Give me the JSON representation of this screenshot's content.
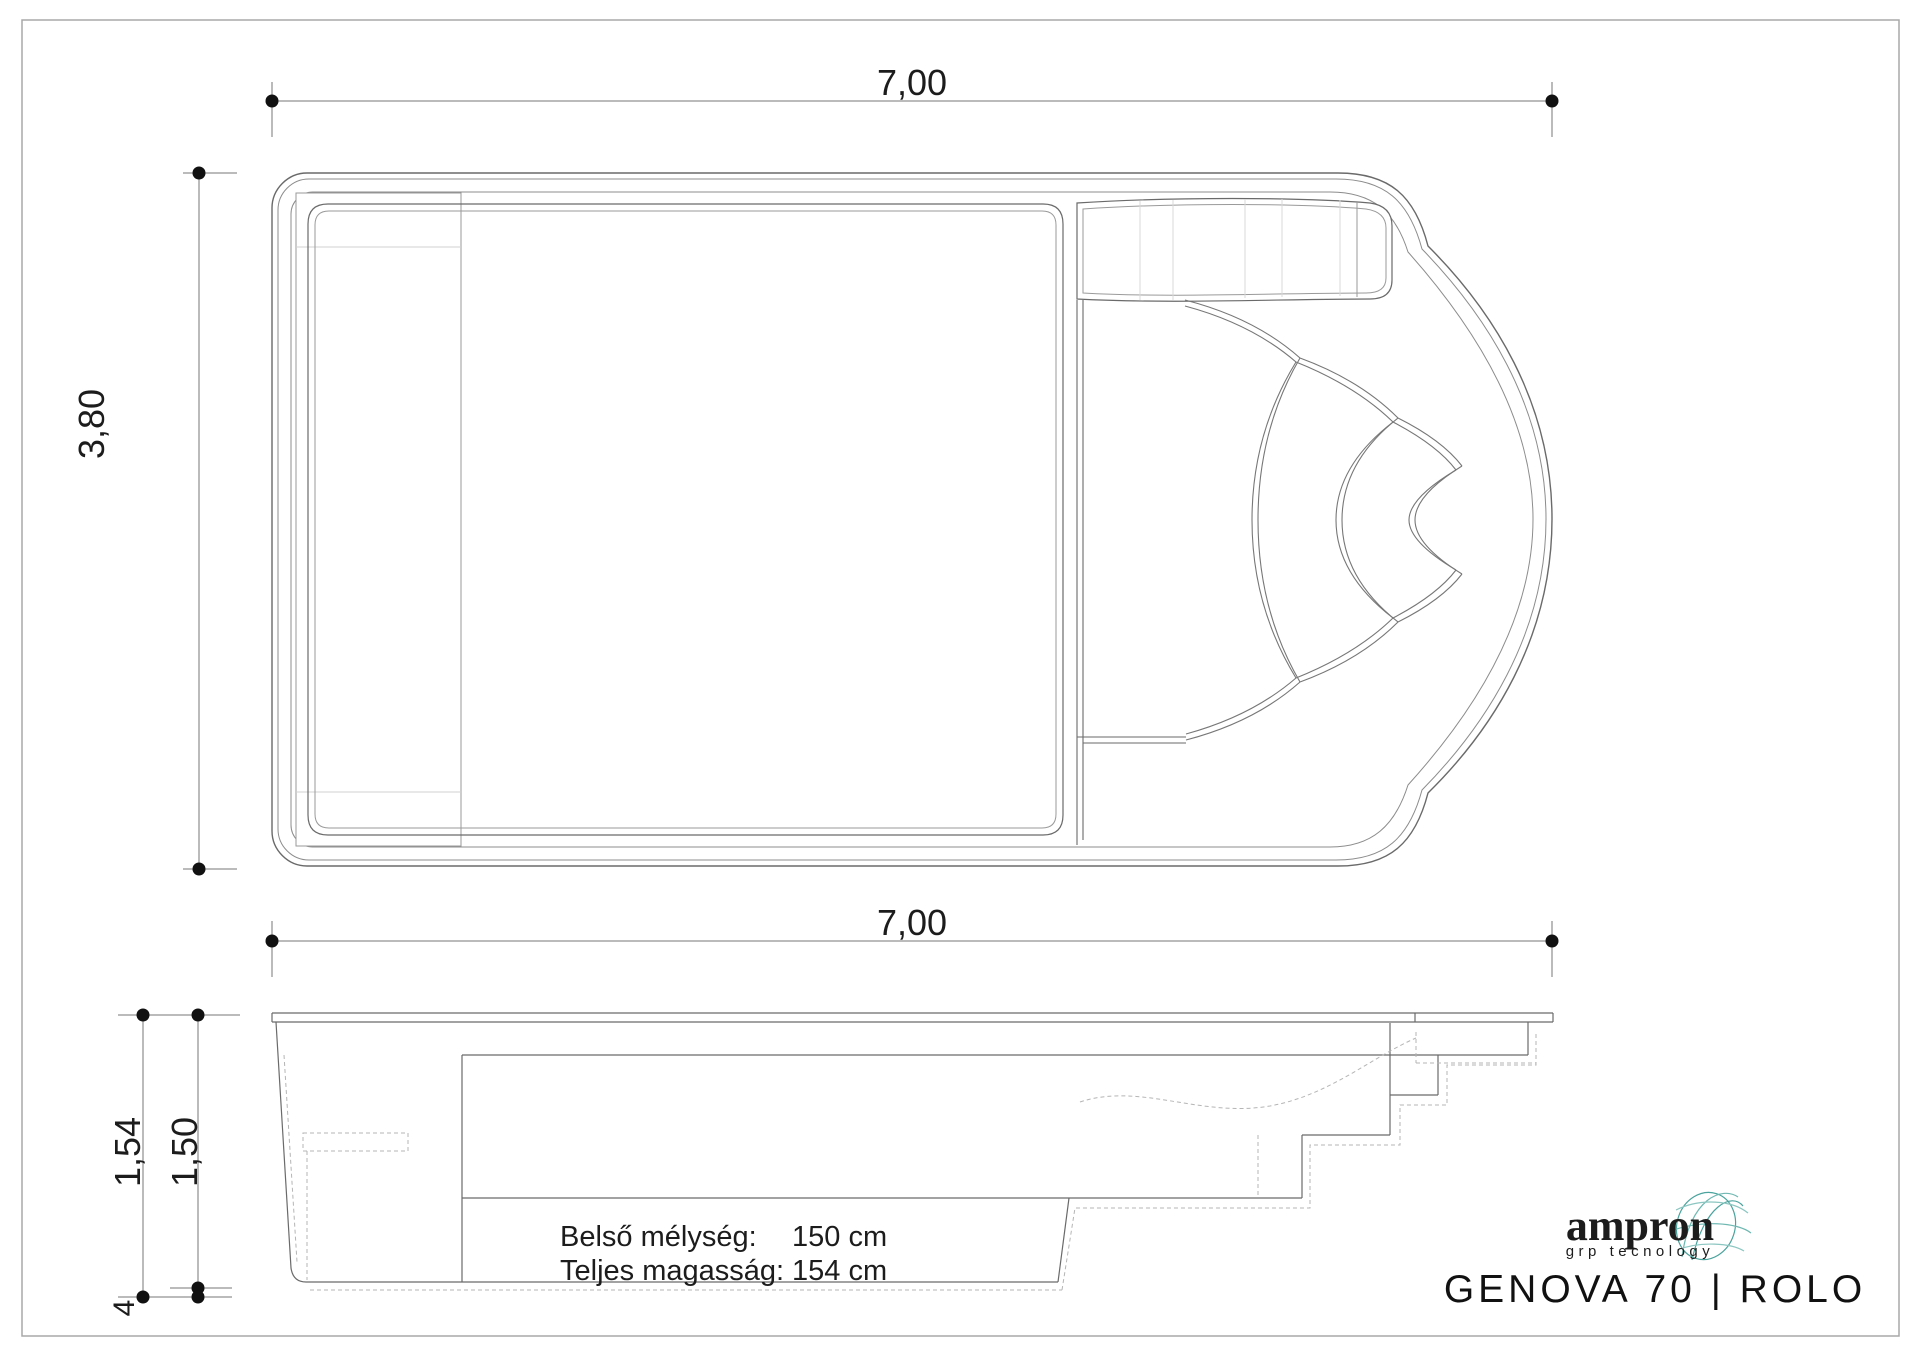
{
  "drawing": {
    "plan": {
      "dim_length": "7,00",
      "dim_width": "3,80"
    },
    "section": {
      "dim_length": "7,00",
      "dim_total_height": "1,54",
      "dim_inner_depth": "1,50",
      "dim_shell_offset": "4"
    },
    "specs": {
      "inner_depth_label": "Belső mélység:",
      "inner_depth_value": "150 cm",
      "total_height_label": "Teljes magasság:",
      "total_height_value": "154 cm"
    },
    "title_block": {
      "brand": "ampron",
      "brand_tagline": "grp tecnology",
      "model": "GENOVA 70  |  ROLO"
    },
    "colors": {
      "brand_navy": "#25357e",
      "brand_teal": "#4aa39d",
      "line_main": "#6a6a6a",
      "line_light": "#9a9a9a",
      "line_faint": "#d0d0d0",
      "dot": "#111111"
    }
  }
}
